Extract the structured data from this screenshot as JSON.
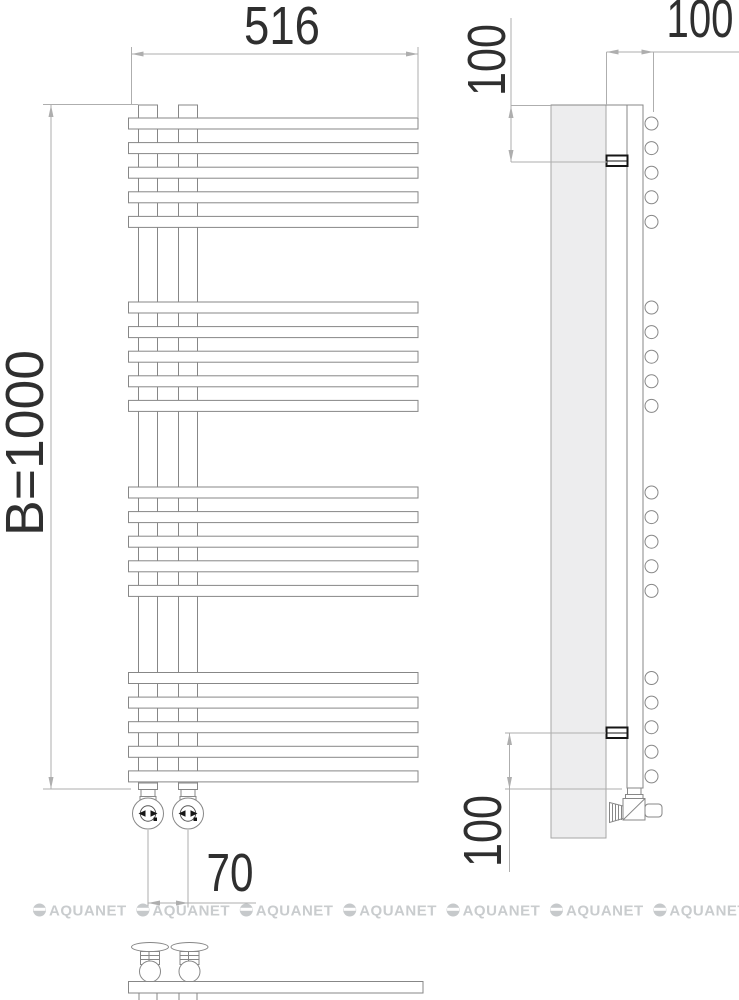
{
  "page": {
    "background": "#ffffff"
  },
  "dimensions": {
    "width_label": "516",
    "height_label": "B=1000",
    "valve_spacing_label": "70",
    "top_bracket_offset_label": "100",
    "bottom_bracket_offset_label": "100",
    "depth_label": "100"
  },
  "watermark": {
    "text": "AQUANET",
    "count": 7,
    "start_x": 33,
    "step_x": 103.4,
    "y": 910
  },
  "drawing": {
    "type": "technical-drawing",
    "object": "heated towel rail: front view, side view, bottom view",
    "front": {
      "rail_left": 128.5,
      "rail_width": 289.5,
      "rail_height": 11,
      "rails_per_group": 5,
      "rail_pitch": 24.6,
      "group_tops": [
        118,
        302,
        487,
        672.5
      ],
      "pipe_xs": [
        138.5,
        178.5
      ],
      "pipe_width": 19,
      "pipe_top": 105,
      "pipe_bottom": 789,
      "valve_centers_x": [
        148,
        188
      ]
    },
    "side": {
      "panel": {
        "x": 551,
        "y": 105,
        "w": 55,
        "h": 733
      },
      "pipe": {
        "x": 627,
        "y": 105,
        "w": 16,
        "h": 683
      },
      "circle_cx": 651.5,
      "circle_r": 6.5,
      "bracket_tops": [
        155.5,
        727.5
      ]
    },
    "bottom": {
      "bar": {
        "x": 128.5,
        "y": 981.5,
        "w": 294.5,
        "h": 11.5
      },
      "valve_centers_x": [
        150,
        189.5
      ]
    },
    "colors": {
      "outline": "#878787",
      "dim_line": "#aeaeae",
      "dim_text": "#2f2f2f",
      "panel_fill": "#ededee",
      "bracket": "#161616",
      "watermark": "#c6c9cb"
    }
  }
}
